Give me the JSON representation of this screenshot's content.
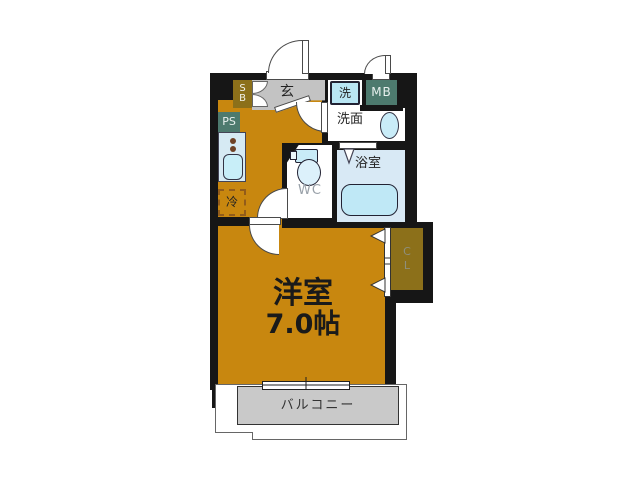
{
  "title": "1K apartment floor plan",
  "rooms": {
    "entrance_label": "玄",
    "washer_label": "洗",
    "meter_box_label": "MB",
    "washroom_label": "洗面",
    "bathroom_label": "浴室",
    "toilet_label": "WC",
    "fridge_label": "冷",
    "pipe_space_line1": "P",
    "pipe_space_line2": "S",
    "shoe_box_line1": "S",
    "shoe_box_line2": "B",
    "closet_line1": "C",
    "closet_line2": "L",
    "main_room_name": "洋室",
    "main_room_size": "7.0帖",
    "balcony_label": "バルコニー"
  },
  "colors": {
    "wall": "#161616",
    "floor_orange": "#C8870F",
    "olive_box": "#8C701A",
    "teal_box": "#4D7A6E",
    "entrance_gray": "#C3C3C3",
    "balcony_gray": "#C9C9C9",
    "bath_blue": "#D8E9F5",
    "fixture_cyan": "#C2EAF7",
    "counter_blue": "#D6EAF3",
    "background": "#ffffff"
  }
}
